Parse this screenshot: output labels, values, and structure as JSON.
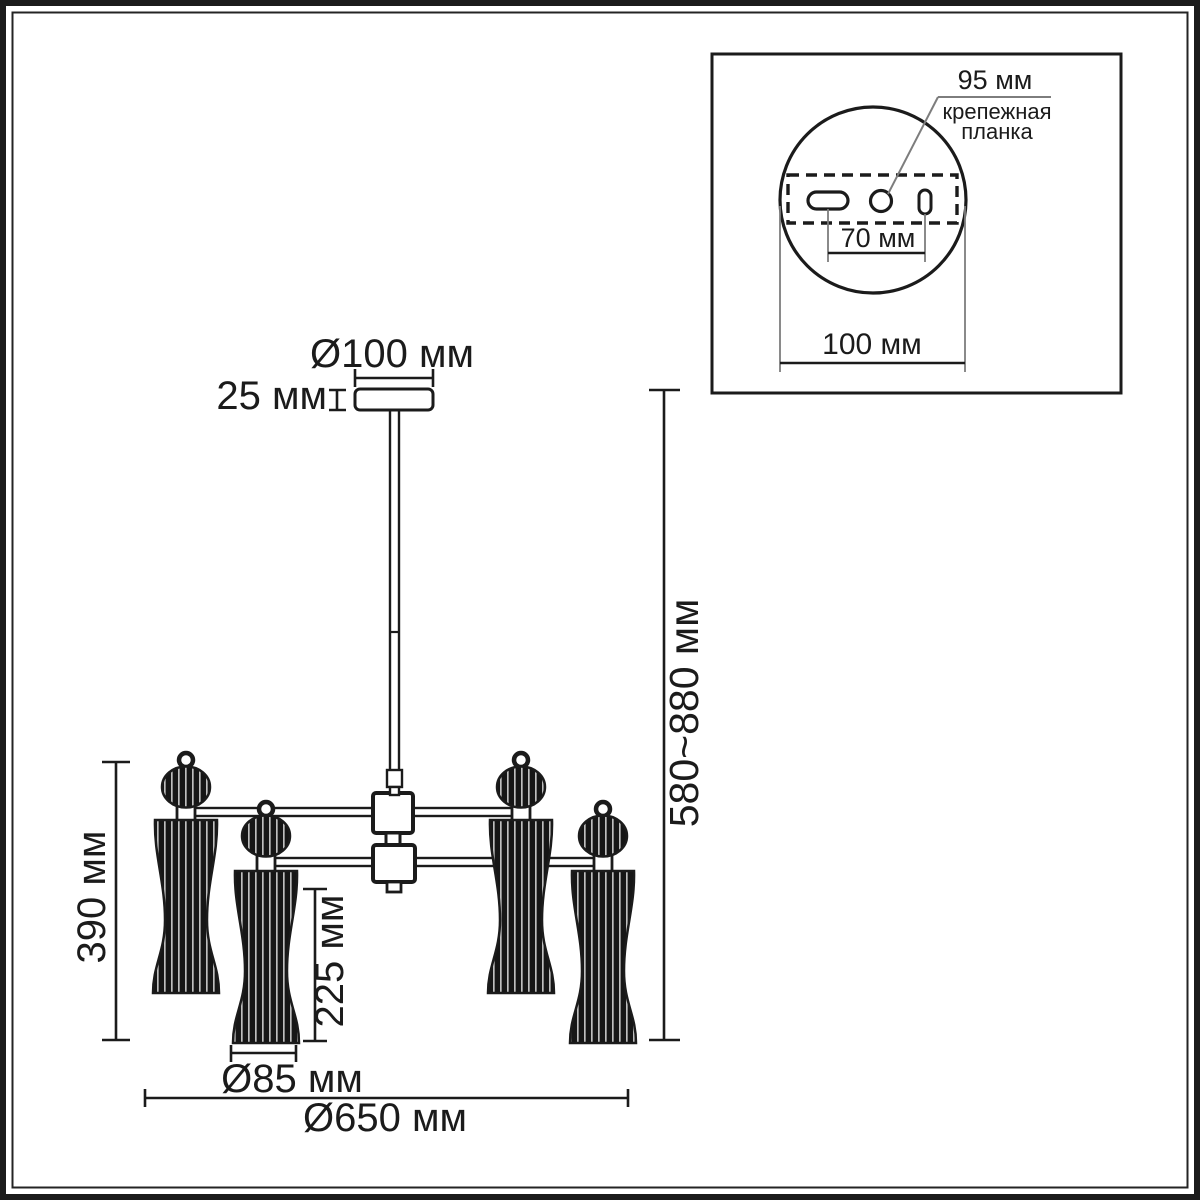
{
  "colors": {
    "ink": "#1b1b1b",
    "leader_gray": "#7d7d7d",
    "background": "#ffffff"
  },
  "main_view": {
    "dim_canopy_diameter": "Ø100 мм",
    "dim_canopy_height": "25 мм",
    "dim_height_range": "580~880 мм",
    "dim_body_height": "390 мм",
    "dim_shade_height": "225 мм",
    "dim_shade_diameter": "Ø85 мм",
    "dim_overall_diameter": "Ø650 мм"
  },
  "inset_view": {
    "dim_plate_length": "95 мм",
    "plate_label_line1": "крепежная",
    "plate_label_line2": "планка",
    "dim_hole_spacing": "70 мм",
    "dim_base_diameter": "100 мм"
  }
}
